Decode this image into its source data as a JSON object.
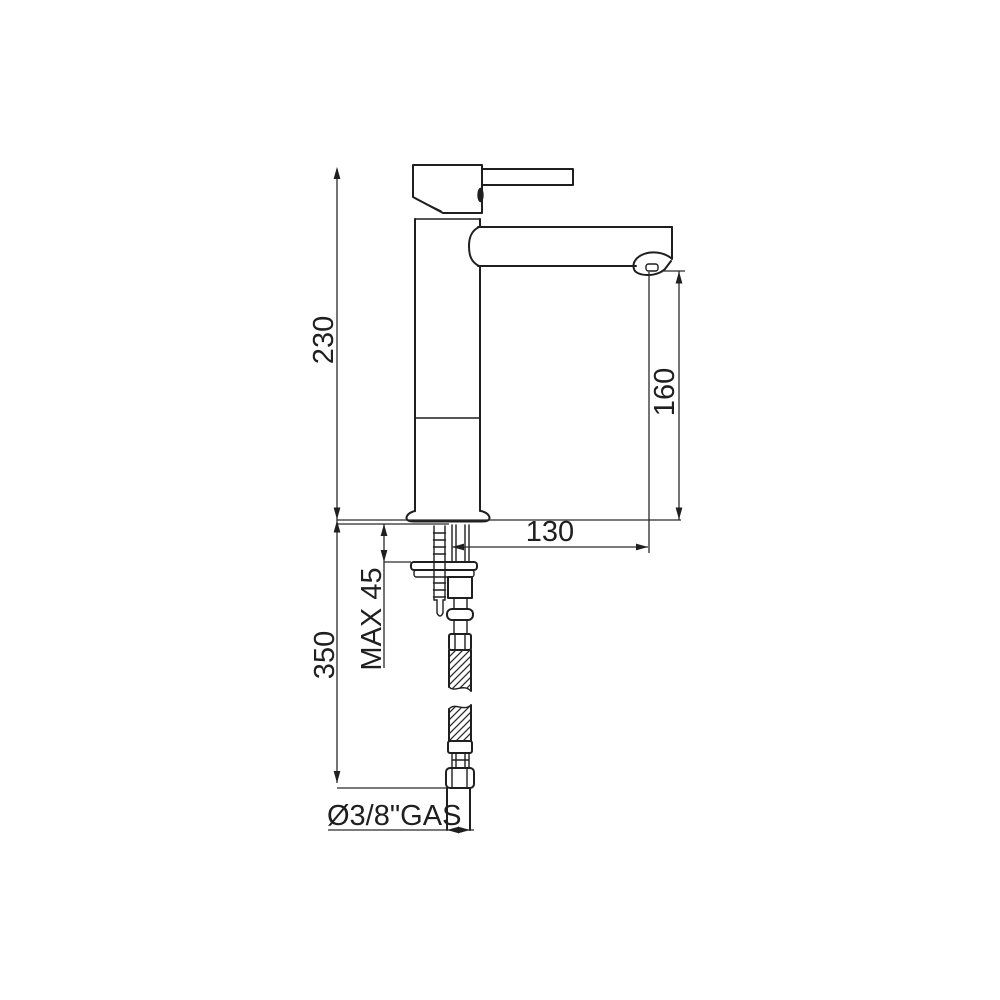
{
  "diagram": {
    "type": "technical-drawing",
    "subject": "single-lever basin mixer tap, side elevation with installation dimensions",
    "colors": {
      "background": "#ffffff",
      "line": "#1f1f1f"
    },
    "labels": {
      "total_height": "230",
      "spout_height": "160",
      "spout_reach": "130",
      "max_deck_thickness": "MAX 45",
      "below_deck_length": "350",
      "supply_connection": "Ø3/8\"GAS"
    }
  }
}
